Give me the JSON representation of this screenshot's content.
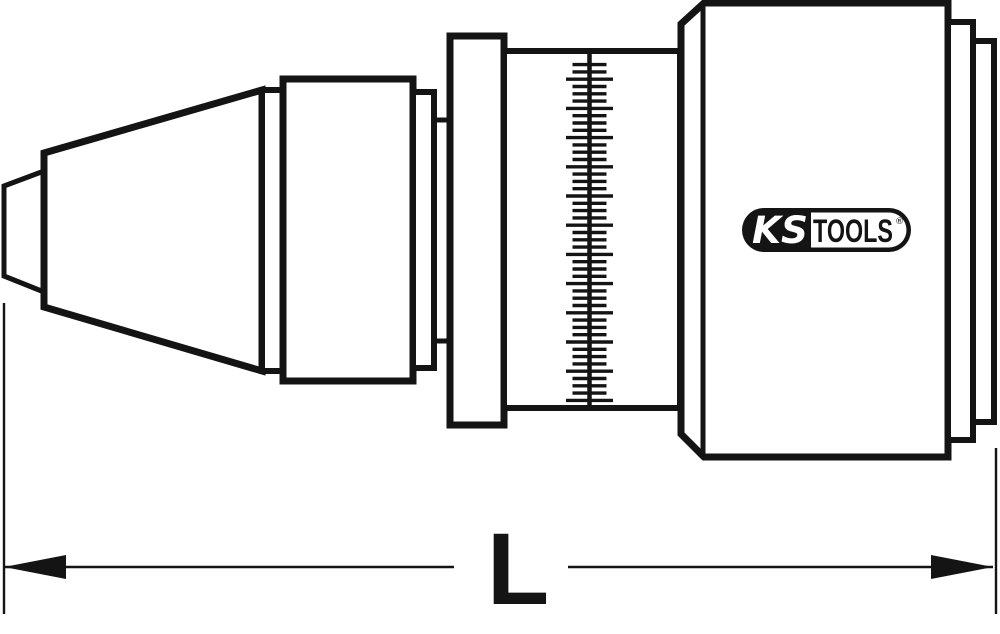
{
  "colors": {
    "line": "#141414",
    "fill": "#ffffff",
    "background": "#ffffff"
  },
  "logo": {
    "text_left": "KS",
    "text_right": "TOOLS",
    "registered": "®"
  },
  "dimension": {
    "label": "L",
    "line_y": 567,
    "thin_width": 2.4,
    "arrow_len": 62,
    "arrow_half_h": 12,
    "left_witness": {
      "x": 4,
      "y1": 303,
      "y2": 614
    },
    "right_witness": {
      "x": 996,
      "y1": 448,
      "y2": 614
    },
    "left_segment": {
      "x1": 4,
      "x2": 454
    },
    "right_segment": {
      "x1": 568,
      "x2": 993
    }
  },
  "scale": {
    "center_x": 589.5,
    "top": 54,
    "bottom": 406,
    "line_width": 4.5,
    "tick_width": 3.4,
    "first_tick_y": 64.6,
    "tick_spacing": 7.3,
    "major_offset": 2,
    "major_every": 4,
    "major_half_len": 23.5,
    "minor_half_len": 17
  },
  "drawing": {
    "parts": [
      {
        "name": "chuck-tip",
        "type": "polygon",
        "sw": 5,
        "points": [
          [
            4,
            186
          ],
          [
            44,
            171
          ],
          [
            44,
            292
          ],
          [
            4,
            276
          ]
        ]
      },
      {
        "name": "chuck-cone",
        "type": "polygon",
        "sw": 7,
        "points": [
          [
            44,
            153
          ],
          [
            262,
            90
          ],
          [
            262,
            371
          ],
          [
            44,
            307
          ]
        ]
      },
      {
        "name": "collar-front",
        "type": "rect",
        "sw": 6,
        "x": 262,
        "y": 90,
        "w": 21,
        "h": 281
      },
      {
        "name": "sleeve-cylinder",
        "type": "rect",
        "sw": 7,
        "x": 283,
        "y": 79,
        "w": 130,
        "h": 302
      },
      {
        "name": "collar-rear",
        "type": "rect",
        "sw": 6,
        "x": 413,
        "y": 92,
        "w": 21,
        "h": 276
      },
      {
        "name": "neck-top-edge",
        "type": "line",
        "sw": 5,
        "x1": 434,
        "y1": 120,
        "x2": 452,
        "y2": 120
      },
      {
        "name": "neck-bottom-edge",
        "type": "line",
        "sw": 5,
        "x1": 434,
        "y1": 341,
        "x2": 452,
        "y2": 341
      },
      {
        "name": "flange-disc",
        "type": "rect",
        "sw": 7,
        "x": 450,
        "y": 36,
        "w": 54,
        "h": 389
      },
      {
        "name": "scale-drum",
        "type": "rect",
        "sw": 6,
        "x": 504,
        "y": 51,
        "w": 176,
        "h": 357
      },
      {
        "name": "main-body",
        "type": "polygon",
        "sw": 7,
        "points": [
          [
            681,
            24
          ],
          [
            704,
            3
          ],
          [
            948,
            3
          ],
          [
            948,
            457
          ],
          [
            704,
            457
          ],
          [
            681,
            434
          ]
        ]
      },
      {
        "name": "body-chamfer-edge",
        "type": "line",
        "sw": 5,
        "x1": 703,
        "y1": 6,
        "x2": 703,
        "y2": 454
      },
      {
        "name": "end-ring-1",
        "type": "rect",
        "sw": 6,
        "x": 948,
        "y": 22,
        "w": 25,
        "h": 418
      },
      {
        "name": "end-ring-2",
        "type": "rect",
        "sw": 6,
        "x": 973,
        "y": 41,
        "w": 21,
        "h": 381
      }
    ]
  }
}
